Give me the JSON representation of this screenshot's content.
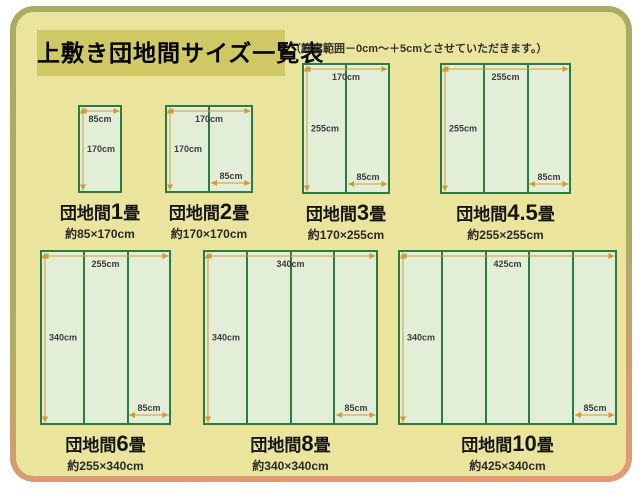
{
  "page": {
    "title": "上敷き団地間サイズ一覧表",
    "note": "（許容範囲－0cm〜＋5cmとさせていただきます。）"
  },
  "colors": {
    "panel_bg": "#eae49c",
    "panel_border_top": "#a7ad62",
    "panel_border_bottom": "#e29a74",
    "title_band_bg": "#d0c765",
    "mat_fill": "#e3eed9",
    "mat_border": "#2c7b43",
    "measure_line": "#d6992f",
    "measure_text": "#3c3c3c"
  },
  "mat_unit_cm": 85,
  "diagrams": [
    {
      "label_prefix": "団地間",
      "label_num": "1",
      "label_unit": "畳",
      "size_label": "約85×170cm",
      "width_cm": 85,
      "height_cm": 170,
      "top_label": "85cm",
      "left_label": "170cm",
      "inner_label": null
    },
    {
      "label_prefix": "団地間",
      "label_num": "2",
      "label_unit": "畳",
      "size_label": "約170×170cm",
      "width_cm": 170,
      "height_cm": 170,
      "top_label": "170cm",
      "left_label": "170cm",
      "inner_label": "85cm"
    },
    {
      "label_prefix": "団地間",
      "label_num": "3",
      "label_unit": "畳",
      "size_label": "約170×255cm",
      "width_cm": 170,
      "height_cm": 255,
      "top_label": "170cm",
      "left_label": "255cm",
      "inner_label": "85cm"
    },
    {
      "label_prefix": "団地間",
      "label_num": "4.5",
      "label_unit": "畳",
      "size_label": "約255×255cm",
      "width_cm": 255,
      "height_cm": 255,
      "top_label": "255cm",
      "left_label": "255cm",
      "inner_label": "85cm"
    },
    {
      "label_prefix": "団地間",
      "label_num": "6",
      "label_unit": "畳",
      "size_label": "約255×340cm",
      "width_cm": 255,
      "height_cm": 340,
      "top_label": "255cm",
      "left_label": "340cm",
      "inner_label": "85cm"
    },
    {
      "label_prefix": "団地間",
      "label_num": "8",
      "label_unit": "畳",
      "size_label": "約340×340cm",
      "width_cm": 340,
      "height_cm": 340,
      "top_label": "340cm",
      "left_label": "340cm",
      "inner_label": "85cm"
    },
    {
      "label_prefix": "団地間",
      "label_num": "10",
      "label_unit": "畳",
      "size_label": "約425×340cm",
      "width_cm": 425,
      "height_cm": 340,
      "top_label": "425cm",
      "left_label": "340cm",
      "inner_label": "85cm"
    }
  ]
}
